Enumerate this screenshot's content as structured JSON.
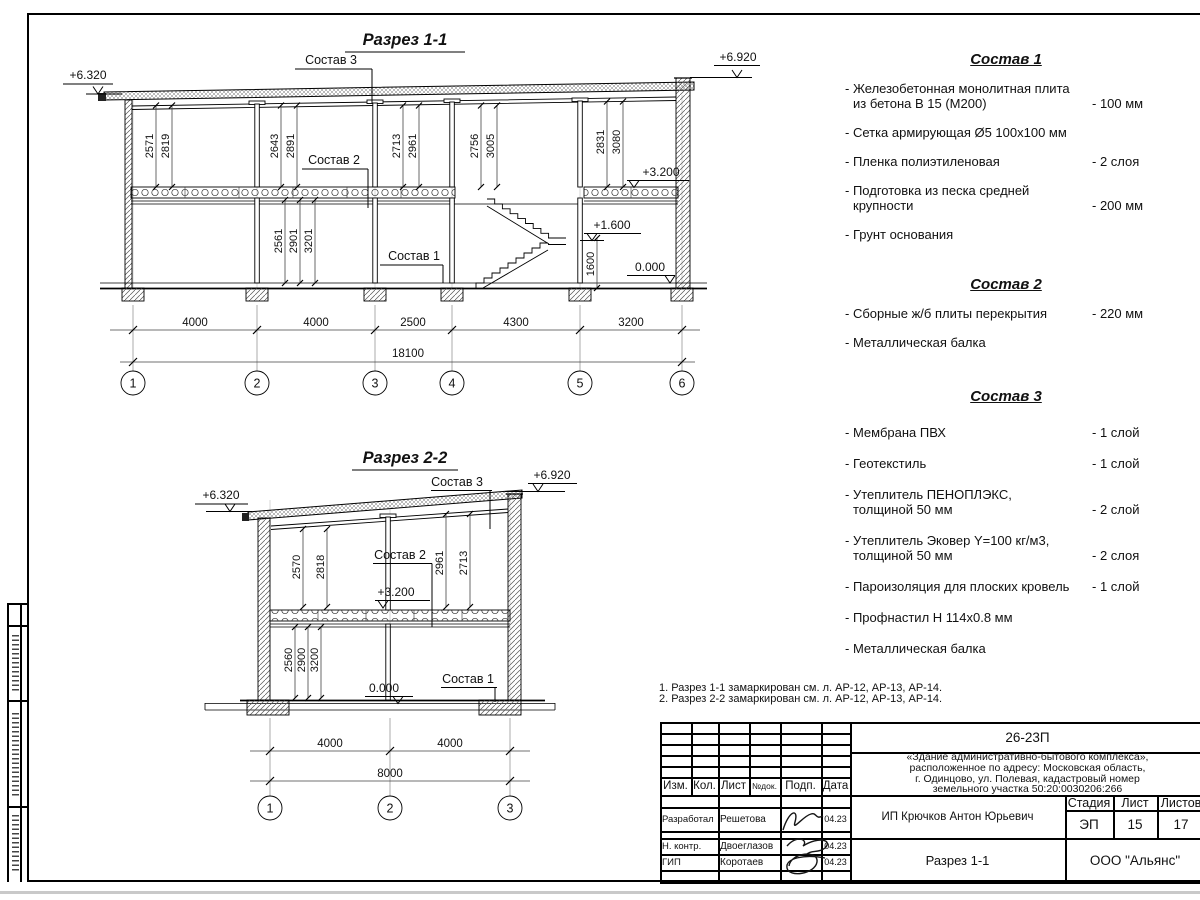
{
  "s11": {
    "title": "Разрез 1-1",
    "elev_left": "+6.320",
    "elev_right": "+6.920",
    "elev_floor": "+3.200",
    "elev_landing": "+1.600",
    "elev_zero": "0.000",
    "dim_landing": "1600",
    "label_sostav1": "Состав 1",
    "label_sostav2": "Состав 2",
    "label_sostav3": "Состав 3",
    "upper_dims": [
      [
        "2571",
        "2819"
      ],
      [
        "2643",
        "2891"
      ],
      [
        "2713",
        "2961"
      ],
      [
        "2756",
        "3005"
      ],
      [
        "2831",
        "3080"
      ]
    ],
    "lower_dims": [
      "2561",
      "2901",
      "3201"
    ],
    "span_dims": [
      "4000",
      "4000",
      "2500",
      "4300",
      "3200"
    ],
    "total_dim": "18100",
    "axes": [
      "1",
      "2",
      "3",
      "4",
      "5",
      "6"
    ]
  },
  "s22": {
    "title": "Разрез 2-2",
    "elev_left": "+6.320",
    "elev_right": "+6.920",
    "elev_floor": "+3.200",
    "elev_zero": "0.000",
    "label_sostav1": "Состав 1",
    "label_sostav2": "Состав 2",
    "label_sostav3": "Состав 3",
    "upper_dims_left": [
      "2570",
      "2818"
    ],
    "upper_dims_right": [
      "2961",
      "2713"
    ],
    "lower_dims": [
      "2560",
      "2900",
      "3200"
    ],
    "span_dims": [
      "4000",
      "4000"
    ],
    "total_dim": "8000",
    "axes": [
      "1",
      "2",
      "3"
    ]
  },
  "compositions": [
    {
      "title": "Состав 1",
      "items": [
        {
          "line1": "- Железобетонная  монолитная плита",
          "line2": "из бетона В 15 (М200)",
          "value": "- 100 мм"
        },
        {
          "line1": "- Сетка армирующая Ø5 100х100 мм",
          "line2": "",
          "value": ""
        },
        {
          "line1": "- Пленка полиэтиленовая",
          "line2": "",
          "value": "-  2 слоя"
        },
        {
          "line1": "- Подготовка из песка средней",
          "line2": "крупности",
          "value": "- 200 мм"
        },
        {
          "line1": "- Грунт основания",
          "line2": "",
          "value": ""
        }
      ]
    },
    {
      "title": "Состав 2",
      "items": [
        {
          "line1": "- Сборные ж/б плиты перекрытия",
          "line2": "",
          "value": "- 220 мм"
        },
        {
          "line1": "- Металлическая балка",
          "line2": "",
          "value": ""
        }
      ]
    },
    {
      "title": "Состав 3",
      "items": [
        {
          "line1": "- Мембрана ПВХ",
          "line2": "",
          "value": "- 1 слой"
        },
        {
          "line1": "- Геотекстиль",
          "line2": "",
          "value": "- 1 слой"
        },
        {
          "line1": "- Утеплитель ПЕНОПЛЭКС,",
          "line2": "толщиной 50 мм",
          "value": "- 2 слой"
        },
        {
          "line1": "- Утеплитель Эковер Y=100 кг/м3,",
          "line2": "толщиной 50 мм",
          "value": "- 2 слоя"
        },
        {
          "line1": "- Пароизоляция для плоских кровель",
          "line2": "",
          "value": "- 1 слой"
        },
        {
          "line1": "- Профнастил Н 114х0.8 мм",
          "line2": "",
          "value": ""
        },
        {
          "line1": "- Металлическая балка",
          "line2": "",
          "value": ""
        }
      ]
    }
  ],
  "notes": [
    "1. Разрез 1-1 замаркирован см. л. АР-12, АР-13, АР-14.",
    "2. Разрез 2-2 замаркирован см. л. АР-12, АР-13, АР-14."
  ],
  "title_block": {
    "doc_code": "26-23П",
    "project_lines": [
      "«Здание административно-бытового комплекса»,",
      "расположенное по адресу: Московская область,",
      "г. Одинцово, ул. Полевая, кадастровый номер",
      "земельного участка 50:20:0030206:266"
    ],
    "client": "ИП Крючков Антон Юрьевич",
    "drawing_title": "Разрез 1-1",
    "company": "ООО \"Альянс\"",
    "stage_label": "Стадия",
    "sheet_label": "Лист",
    "sheets_label": "Листов",
    "stage": "ЭП",
    "sheet": "15",
    "sheets": "17",
    "header": [
      "Изм.",
      "Кол.",
      "Лист",
      "№док.",
      "Подп.",
      "Дата"
    ],
    "rows": [
      {
        "role": "Разработал",
        "name": "Решетова",
        "date": "04.23"
      },
      {
        "role": "Н. контр.",
        "name": "Двоеглазов",
        "date": "04.23"
      },
      {
        "role": "ГИП",
        "name": "Коротаев",
        "date": "04.23"
      }
    ]
  }
}
